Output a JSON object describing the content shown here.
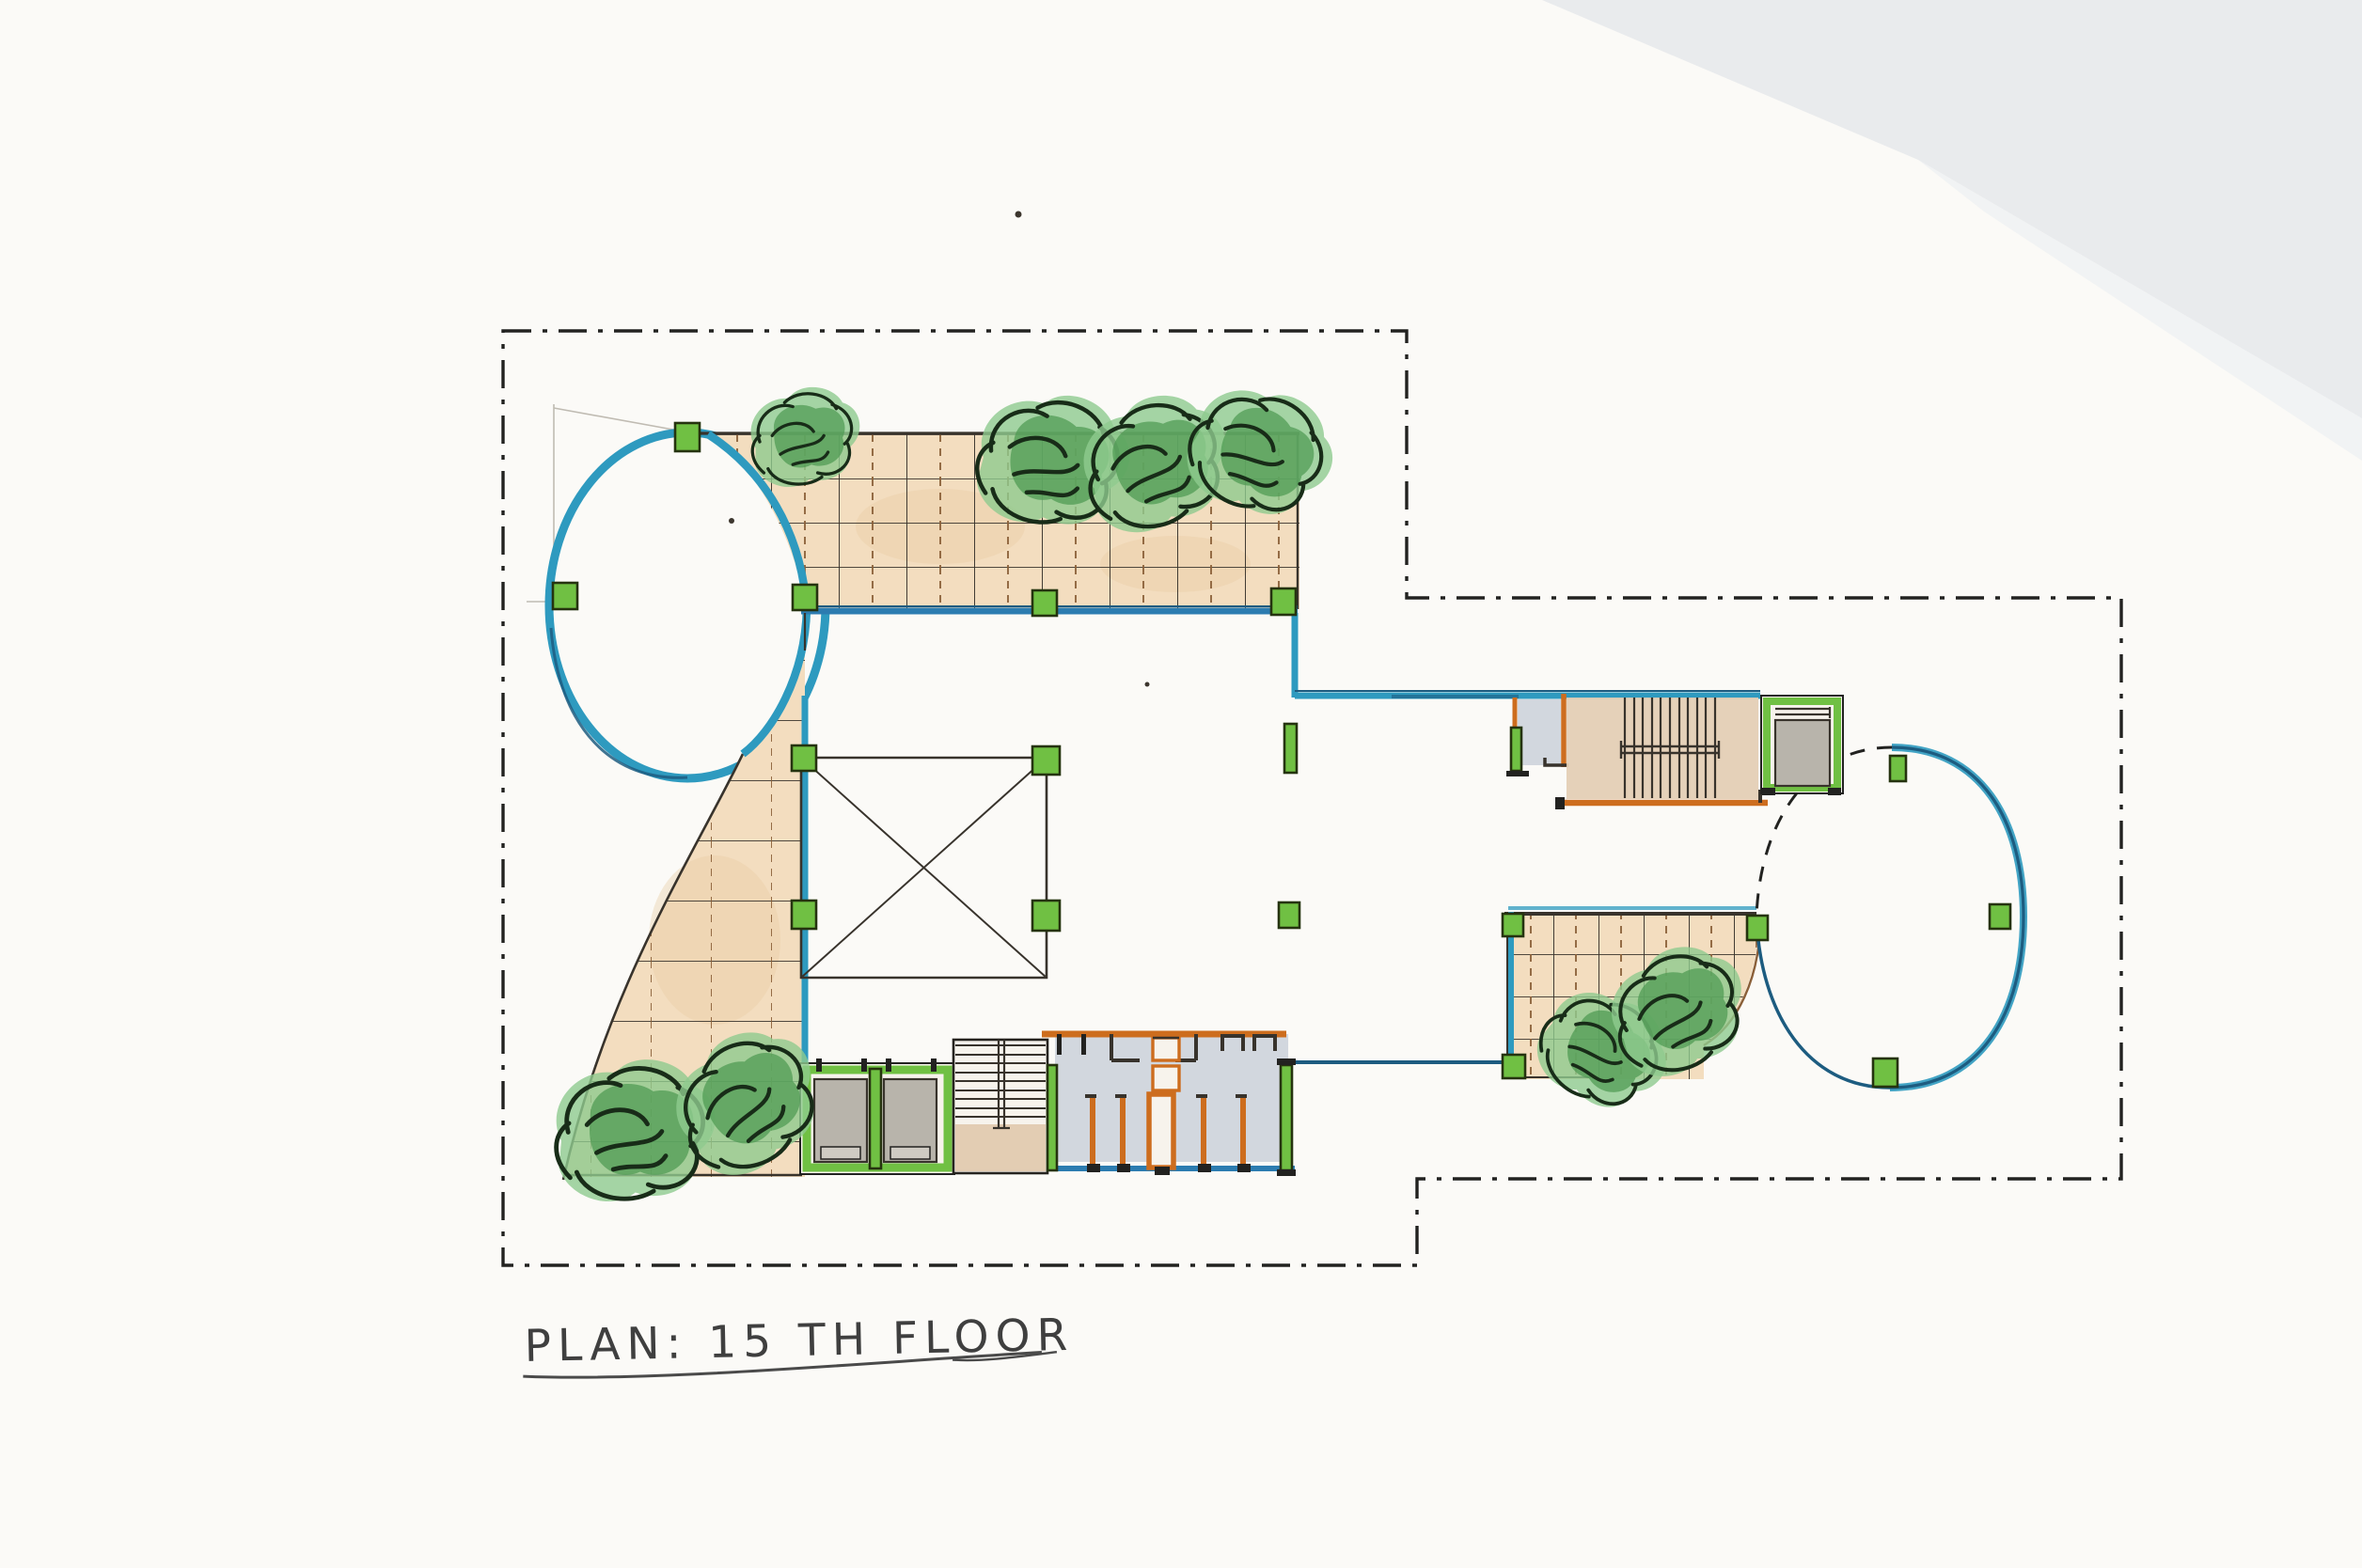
{
  "document": {
    "title": "PLAN: 15 TH FLOOR"
  },
  "symbols": {
    "tree_icon": "hand-drawn shrub scribble",
    "column_marker": "green structural column square",
    "boundary_line": "dash-dot property setback line",
    "hidden_edge": "dashed hidden curve of east oval deck",
    "x_box": "atrium / skylight opening marked with X"
  },
  "palette": {
    "paper": "#fbfaf7",
    "wash": "#e5e8eb",
    "ink": "#222220",
    "pencil": "#a09a8e",
    "teal": "#2e9abf",
    "navy": "#1d5c80",
    "blue_line": "#2c7cb0",
    "green": "#70c043",
    "green_dark": "#25330f",
    "tan": "#f3ddbf",
    "tan_deep": "#e9cea5",
    "grid_brown": "#8a5f38",
    "grid_black": "#38332c",
    "orange": "#cd6d1e",
    "gray": "#b8b4ab",
    "room": "#d2d7de",
    "stair_tan": "#e3cdb3",
    "tree_dark": "#4e9a52",
    "tree_light": "#8fca8e",
    "tree_ink": "#182c18",
    "text": "#3f3f3f"
  }
}
